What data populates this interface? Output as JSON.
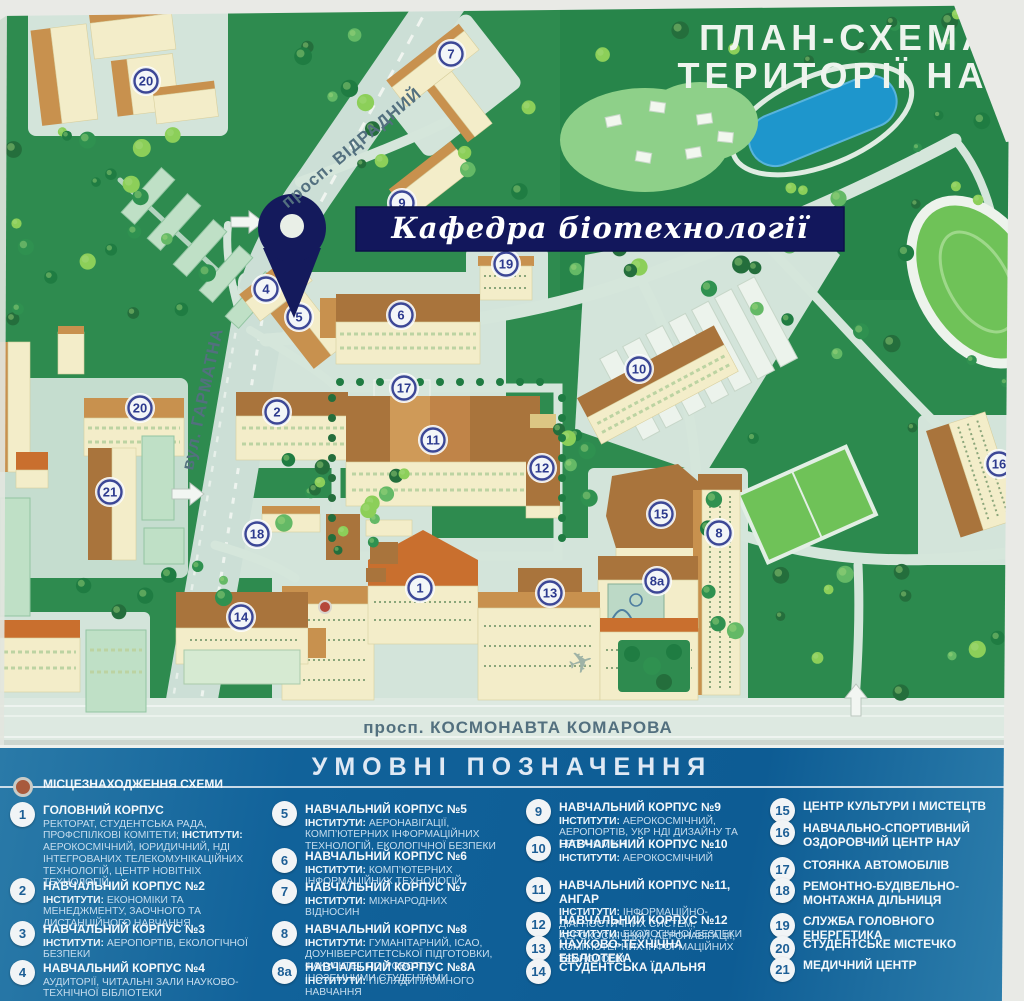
{
  "map": {
    "title_line1": "ПЛАН-СХЕМА",
    "title_line2": "ТЕРИТОРІЇ НАУ",
    "banner_label": "Кафедра біотехнології",
    "streets": {
      "vidradny": "просп. ВІДРАДНИЙ",
      "harmatna": "вул. ГАРМАТНА",
      "komarova": "просп. КОСМОНАВТА КОМАРОВА"
    },
    "colors": {
      "map_green": "#2e8b4f",
      "road": "#ccdfd6",
      "building_wall": "#f3edc9",
      "roof_brown": "#a9743c",
      "banner_navy": "#12175c",
      "pond_blue": "#1e96cc",
      "legend_blue": "#0d5c94"
    },
    "markers": [
      {
        "label": "20",
        "x": 146,
        "y": 81
      },
      {
        "label": "7",
        "x": 451,
        "y": 54
      },
      {
        "label": "9",
        "x": 402,
        "y": 203
      },
      {
        "label": "19",
        "x": 506,
        "y": 264
      },
      {
        "label": "4",
        "x": 266,
        "y": 289
      },
      {
        "label": "6",
        "x": 401,
        "y": 315
      },
      {
        "label": "5",
        "x": 299,
        "y": 317
      },
      {
        "label": "10",
        "x": 639,
        "y": 369
      },
      {
        "label": "17",
        "x": 404,
        "y": 388
      },
      {
        "label": "20",
        "x": 140,
        "y": 408
      },
      {
        "label": "2",
        "x": 277,
        "y": 412
      },
      {
        "label": "11",
        "x": 433,
        "y": 440
      },
      {
        "label": "12",
        "x": 542,
        "y": 468
      },
      {
        "label": "16",
        "x": 999,
        "y": 464
      },
      {
        "label": "21",
        "x": 110,
        "y": 492
      },
      {
        "label": "15",
        "x": 661,
        "y": 514
      },
      {
        "label": "8",
        "x": 719,
        "y": 533
      },
      {
        "label": "18",
        "x": 257,
        "y": 534
      },
      {
        "label": "8a",
        "x": 657,
        "y": 581
      },
      {
        "label": "1",
        "x": 420,
        "y": 588
      },
      {
        "label": "13",
        "x": 550,
        "y": 593
      },
      {
        "label": "14",
        "x": 241,
        "y": 617
      }
    ],
    "location_dot": {
      "x": 325,
      "y": 607
    },
    "arrows": [
      {
        "x": 188,
        "y": 494,
        "rot": 0
      },
      {
        "x": 247,
        "y": 222,
        "rot": 0
      },
      {
        "x": 856,
        "y": 700,
        "rot": -90
      }
    ]
  },
  "legend": {
    "title": "УМОВНІ ПОЗНАЧЕННЯ",
    "columns": [
      [
        {
          "loc": true,
          "title": "МІСЦЕЗНАХОДЖЕННЯ СХЕМИ"
        },
        {
          "num": "1",
          "title": "ГОЛОВНИЙ КОРПУС",
          "desc": [
            {
              "t": "РЕКТОРАТ, СТУДЕНТСЬКА РАДА, ПРОФСПІЛКОВІ КОМІТЕТИ; "
            },
            {
              "b": "ІНСТИТУТИ:",
              "t": " АЕРОКОСМІЧНИЙ, ЮРИДИЧНИЙ, НДІ ІНТЕГРОВАНИХ ТЕЛЕКОМУНІКАЦІЙНИХ ТЕХНОЛОГІЙ, ЦЕНТР НОВІТНІХ ТЕХНОЛОГІЙ"
            }
          ]
        },
        {
          "num": "2",
          "title": "НАВЧАЛЬНИЙ КОРПУС №2",
          "desc": [
            {
              "b": "ІНСТИТУТИ:",
              "t": " ЕКОНОМІКИ ТА МЕНЕДЖМЕНТУ, ЗАОЧНОГО ТА ДИСТАНЦІЙНОГО НАВЧАННЯ"
            }
          ]
        },
        {
          "num": "3",
          "title": "НАВЧАЛЬНИЙ КОРПУС №3",
          "desc": [
            {
              "b": "ІНСТИТУТИ:",
              "t": " АЕРОПОРТІВ, ЕКОЛОГІЧНОЇ БЕЗПЕКИ"
            }
          ]
        },
        {
          "num": "4",
          "title": "НАВЧАЛЬНИЙ КОРПУС №4",
          "desc": [
            {
              "t": "АУДИТОРІЇ, ЧИТАЛЬНІ ЗАЛИ НАУКОВО-ТЕХНІЧНОЇ БІБЛІОТЕКИ"
            }
          ]
        }
      ],
      [
        {
          "num": "5",
          "title": "НАВЧАЛЬНИЙ КОРПУС №5",
          "desc": [
            {
              "b": "ІНСТИТУТИ:",
              "t": " АЕРОНАВІГАЦІЇ, КОМП’ЮТЕРНИХ ІНФОРМАЦІЙНИХ ТЕХНОЛОГІЙ, ЕКОЛОГІЧНОЇ БЕЗПЕКИ"
            }
          ]
        },
        {
          "num": "6",
          "title": "НАВЧАЛЬНИЙ КОРПУС №6",
          "desc": [
            {
              "b": "ІНСТИТУТИ:",
              "t": " КОМП’ЮТЕРНИХ ІНФОРМАЦІЙНИХ ТЕХНОЛОГІЙ"
            }
          ]
        },
        {
          "num": "7",
          "title": "НАВЧАЛЬНИЙ КОРПУС №7",
          "desc": [
            {
              "b": "ІНСТИТУТИ:",
              "t": " МІЖНАРОДНИХ ВІДНОСИН"
            }
          ]
        },
        {
          "num": "8",
          "title": "НАВЧАЛЬНИЙ КОРПУС №8",
          "desc": [
            {
              "b": "ІНСТИТУТИ:",
              "t": " ГУМАНІТАРНИЙ, ICAO, ДОУНІВЕРСИТЕТСЬКОЇ ПІДГОТОВКИ, ФАКУЛЬТЕТ ПО РОБОТІ З ІНОЗЕМНИМИ СТУДЕНТАМИ"
            }
          ]
        },
        {
          "num": "8a",
          "title": "НАВЧАЛЬНИЙ КОРПУС №8А",
          "desc": [
            {
              "b": "ІНСТИТУТИ:",
              "t": " ПІСЛЯДИПЛОМНОГО НАВЧАННЯ"
            }
          ]
        }
      ],
      [
        {
          "num": "9",
          "title": "НАВЧАЛЬНИЙ КОРПУС №9",
          "desc": [
            {
              "b": "ІНСТИТУТИ:",
              "t": " АЕРОКОСМІЧНИЙ, АЕРОПОРТІВ, УКР НДІ ДИЗАЙНУ ТА ЕРГОНОМІКИ"
            }
          ]
        },
        {
          "num": "10",
          "title": "НАВЧАЛЬНИЙ КОРПУС №10",
          "desc": [
            {
              "b": "ІНСТИТУТИ:",
              "t": " АЕРОКОСМІЧНИЙ"
            }
          ]
        },
        {
          "num": "11",
          "title": "НАВЧАЛЬНИЙ КОРПУС №11, АНГАР",
          "desc": [
            {
              "b": "ІНСТИТУТИ:",
              "t": " ІНФОРМАЦІЙНО-ДІАГНОСТИЧНИХ СИСТЕМ, АЕРОКОСМІЧНИЙ, АЕРОНАВІГАЦІЇ, КОМП’ЮТЕРНИХ ІНФОРМАЦІЙНИХ ТЕХНОЛОГІЙ"
            }
          ]
        },
        {
          "num": "12",
          "title": "НАВЧАЛЬНИЙ КОРПУС №12",
          "desc": [
            {
              "b": "ІНСТИТУТИ:",
              "t": " ЕКОЛОГІЧНОЇ БЕЗПЕКИ"
            }
          ]
        },
        {
          "num": "13",
          "title": "НАУКОВО-ТЕХНІЧНА БІБЛІОТЕКА"
        },
        {
          "num": "14",
          "title": "СТУДЕНТСЬКА ЇДАЛЬНЯ"
        }
      ],
      [
        {
          "num": "15",
          "title": "ЦЕНТР КУЛЬТУРИ І МИСТЕЦТВ"
        },
        {
          "num": "16",
          "title": "НАВЧАЛЬНО-СПОРТИВНИЙ ОЗДОРОВЧИЙ ЦЕНТР НАУ"
        },
        {
          "num": "17",
          "title": "СТОЯНКА АВТОМОБІЛІВ"
        },
        {
          "num": "18",
          "title": "РЕМОНТНО-БУДІВЕЛЬНО-МОНТАЖНА ДІЛЬНИЦЯ"
        },
        {
          "num": "19",
          "title": "СЛУЖБА ГОЛОВНОГО ЕНЕРГЕТИКА"
        },
        {
          "num": "20",
          "title": "СТУДЕНТСЬКЕ МІСТЕЧКО"
        },
        {
          "num": "21",
          "title": "МЕДИЧНИЙ ЦЕНТР"
        }
      ]
    ]
  }
}
